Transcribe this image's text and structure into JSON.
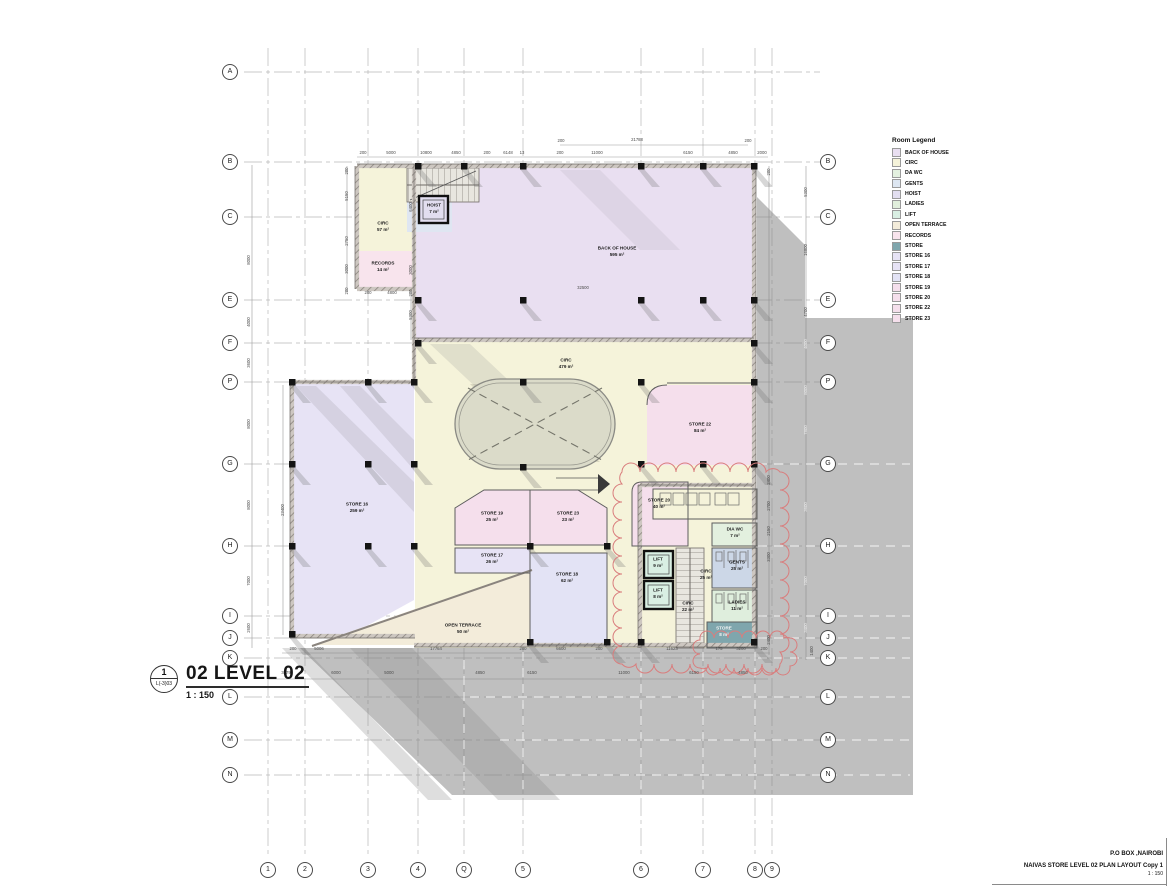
{
  "colors": {
    "shadow": "#808080",
    "grid_line": "#b9b9b9",
    "wall": "#a8a29c",
    "revision_cloud": "#d97d7d",
    "back_of_house": "#e9dff1",
    "circ": "#f5f3da",
    "da_wc": "#e3f0df",
    "gents": "#dde6f1",
    "hoist": "#e2def0",
    "ladies": "#e1efdc",
    "lift": "#d9efe3",
    "open_terrace": "#f3ecda",
    "records": "#f8e4ed",
    "store": "#7fa6ad",
    "store_lavender": "#e7e3f5",
    "store_pink": "#f5dfec"
  },
  "legend": {
    "title": "Room Legend",
    "items": [
      {
        "label": "BACK OF HOUSE",
        "color": "#e9dff1"
      },
      {
        "label": "CIRC",
        "color": "#f5f3da"
      },
      {
        "label": "DA WC",
        "color": "#e3f0df"
      },
      {
        "label": "GENTS",
        "color": "#dde6f1"
      },
      {
        "label": "HOIST",
        "color": "#e2def0"
      },
      {
        "label": "LADIES",
        "color": "#e1efdc"
      },
      {
        "label": "LIFT",
        "color": "#d9efe3"
      },
      {
        "label": "OPEN TERRACE",
        "color": "#f3ecda"
      },
      {
        "label": "RECORDS",
        "color": "#f8e4ed"
      },
      {
        "label": "STORE",
        "color": "#7fa6ad"
      },
      {
        "label": "STORE 16",
        "color": "#e7e3f5"
      },
      {
        "label": "STORE 17",
        "color": "#e7e3f5"
      },
      {
        "label": "STORE 18",
        "color": "#e3e3f5"
      },
      {
        "label": "STORE 19",
        "color": "#f5dfec"
      },
      {
        "label": "STORE 20",
        "color": "#f5dfec"
      },
      {
        "label": "STORE 22",
        "color": "#f5dfec"
      },
      {
        "label": "STORE 23",
        "color": "#f5dfec"
      }
    ]
  },
  "view_title": {
    "marker_number": "1",
    "marker_sheet": "L(-3)03",
    "label": "02 LEVEL 02",
    "scale": "1 : 150"
  },
  "title_block": {
    "address": "P.O BOX ,NAIROBI",
    "drawing": "NAIVAS STORE LEVEL 02 PLAN LAYOUT Copy 1",
    "scale": "1 : 150"
  },
  "grid": {
    "left": [
      {
        "label": "A",
        "x": 230,
        "y": 72
      },
      {
        "label": "B",
        "x": 230,
        "y": 162
      },
      {
        "label": "C",
        "x": 230,
        "y": 217
      },
      {
        "label": "E",
        "x": 230,
        "y": 300
      },
      {
        "label": "F",
        "x": 230,
        "y": 343
      },
      {
        "label": "P",
        "x": 230,
        "y": 382
      },
      {
        "label": "G",
        "x": 230,
        "y": 464
      },
      {
        "label": "H",
        "x": 230,
        "y": 546
      },
      {
        "label": "I",
        "x": 230,
        "y": 616
      },
      {
        "label": "J",
        "x": 230,
        "y": 638
      },
      {
        "label": "K",
        "x": 230,
        "y": 658
      },
      {
        "label": "L",
        "x": 230,
        "y": 697
      },
      {
        "label": "M",
        "x": 230,
        "y": 740
      },
      {
        "label": "N",
        "x": 230,
        "y": 775
      }
    ],
    "right": [
      {
        "label": "B",
        "x": 828,
        "y": 162
      },
      {
        "label": "C",
        "x": 828,
        "y": 217
      },
      {
        "label": "E",
        "x": 828,
        "y": 300
      },
      {
        "label": "F",
        "x": 828,
        "y": 343
      },
      {
        "label": "P",
        "x": 828,
        "y": 382
      },
      {
        "label": "G",
        "x": 828,
        "y": 464
      },
      {
        "label": "H",
        "x": 828,
        "y": 546
      },
      {
        "label": "I",
        "x": 828,
        "y": 616
      },
      {
        "label": "J",
        "x": 828,
        "y": 638
      },
      {
        "label": "K",
        "x": 828,
        "y": 658
      },
      {
        "label": "L",
        "x": 828,
        "y": 697
      },
      {
        "label": "M",
        "x": 828,
        "y": 740
      },
      {
        "label": "N",
        "x": 828,
        "y": 775
      }
    ],
    "bottom": [
      {
        "label": "1",
        "x": 268,
        "y": 870
      },
      {
        "label": "2",
        "x": 305,
        "y": 870
      },
      {
        "label": "3",
        "x": 368,
        "y": 870
      },
      {
        "label": "4",
        "x": 418,
        "y": 870
      },
      {
        "label": "Q",
        "x": 464,
        "y": 870
      },
      {
        "label": "5",
        "x": 523,
        "y": 870
      },
      {
        "label": "6",
        "x": 641,
        "y": 870
      },
      {
        "label": "7",
        "x": 703,
        "y": 870
      },
      {
        "label": "8",
        "x": 755,
        "y": 870
      },
      {
        "label": "9",
        "x": 772,
        "y": 870
      }
    ]
  },
  "rooms": [
    {
      "name": "CIRC",
      "area": "57 m²",
      "x": 383,
      "y": 227
    },
    {
      "name": "RECORDS",
      "area": "14 m²",
      "x": 383,
      "y": 267
    },
    {
      "name": "HOIST",
      "area": "7 m²",
      "x": 434,
      "y": 209
    },
    {
      "name": "BACK OF HOUSE",
      "area": "595 m²",
      "x": 617,
      "y": 252
    },
    {
      "name": "CIRC",
      "area": "479 m²",
      "x": 566,
      "y": 364
    },
    {
      "name": "STORE 16",
      "area": "259 m²",
      "x": 357,
      "y": 508
    },
    {
      "name": "STORE 22",
      "area": "84 m²",
      "x": 700,
      "y": 428
    },
    {
      "name": "STORE 19",
      "area": "25 m²",
      "x": 492,
      "y": 517
    },
    {
      "name": "STORE 23",
      "area": "23 m²",
      "x": 568,
      "y": 517
    },
    {
      "name": "STORE 17",
      "area": "26 m²",
      "x": 492,
      "y": 559
    },
    {
      "name": "STORE 18",
      "area": "62 m²",
      "x": 567,
      "y": 578
    },
    {
      "name": "OPEN TERRACE",
      "area": "50 m²",
      "x": 463,
      "y": 629
    },
    {
      "name": "STORE 20",
      "area": "40 m²",
      "x": 659,
      "y": 504
    },
    {
      "name": "DIA WC",
      "area": "7 m²",
      "x": 735,
      "y": 533
    },
    {
      "name": "GENTS",
      "area": "25 m²",
      "x": 737,
      "y": 566
    },
    {
      "name": "CIRC",
      "area": "25 m²",
      "x": 706,
      "y": 575
    },
    {
      "name": "LADIES",
      "area": "11 m²",
      "x": 737,
      "y": 606
    },
    {
      "name": "CIRC",
      "area": "22 m²",
      "x": 688,
      "y": 607
    },
    {
      "name": "STORE",
      "area": "8 m²",
      "x": 724,
      "y": 632,
      "cls": "on-dark"
    },
    {
      "name": "LIFT",
      "area": "9 m²",
      "x": 658,
      "y": 563
    },
    {
      "name": "LIFT",
      "area": "8 m²",
      "x": 658,
      "y": 594
    }
  ],
  "dims": [
    {
      "t": "21788",
      "x": 637,
      "y": 140
    },
    {
      "t": "200",
      "x": 561,
      "y": 141
    },
    {
      "t": "200",
      "x": 748,
      "y": 141
    },
    {
      "t": "200",
      "x": 363,
      "y": 153
    },
    {
      "t": "5000",
      "x": 391,
      "y": 153
    },
    {
      "t": "10800",
      "x": 426,
      "y": 153
    },
    {
      "t": "4850",
      "x": 456,
      "y": 153
    },
    {
      "t": "200",
      "x": 487,
      "y": 153
    },
    {
      "t": "6148",
      "x": 508,
      "y": 153
    },
    {
      "t": "13",
      "x": 522,
      "y": 153
    },
    {
      "t": "200",
      "x": 560,
      "y": 153
    },
    {
      "t": "11000",
      "x": 597,
      "y": 153
    },
    {
      "t": "6150",
      "x": 688,
      "y": 153
    },
    {
      "t": "4850",
      "x": 733,
      "y": 153
    },
    {
      "t": "2000",
      "x": 762,
      "y": 153
    },
    {
      "t": "5150",
      "x": 347,
      "y": 196,
      "cls": "v"
    },
    {
      "t": "2750",
      "x": 347,
      "y": 241,
      "cls": "v"
    },
    {
      "t": "3000",
      "x": 347,
      "y": 269,
      "cls": "v"
    },
    {
      "t": "200",
      "x": 347,
      "y": 171,
      "cls": "v"
    },
    {
      "t": "200",
      "x": 347,
      "y": 291,
      "cls": "v"
    },
    {
      "t": "6400",
      "x": 411,
      "y": 207,
      "cls": "v"
    },
    {
      "t": "3000",
      "x": 411,
      "y": 270,
      "cls": "v"
    },
    {
      "t": "200",
      "x": 411,
      "y": 293,
      "cls": "v"
    },
    {
      "t": "5300",
      "x": 411,
      "y": 315,
      "cls": "v"
    },
    {
      "t": "32500",
      "x": 583,
      "y": 288
    },
    {
      "t": "200",
      "x": 368,
      "y": 293
    },
    {
      "t": "4800",
      "x": 392,
      "y": 293
    },
    {
      "t": "200",
      "x": 293,
      "y": 649
    },
    {
      "t": "5006",
      "x": 319,
      "y": 649
    },
    {
      "t": "17764",
      "x": 436,
      "y": 649
    },
    {
      "t": "200",
      "x": 523,
      "y": 649
    },
    {
      "t": "6600",
      "x": 561,
      "y": 649
    },
    {
      "t": "200",
      "x": 599,
      "y": 649
    },
    {
      "t": "11623",
      "x": 672,
      "y": 649
    },
    {
      "t": "175",
      "x": 719,
      "y": 649
    },
    {
      "t": "3200",
      "x": 741,
      "y": 649
    },
    {
      "t": "200",
      "x": 764,
      "y": 649
    },
    {
      "t": "3579",
      "x": 286,
      "y": 673
    },
    {
      "t": "6000",
      "x": 336,
      "y": 673
    },
    {
      "t": "5000",
      "x": 389,
      "y": 673
    },
    {
      "t": "4850",
      "x": 480,
      "y": 673
    },
    {
      "t": "6150",
      "x": 532,
      "y": 673
    },
    {
      "t": "11000",
      "x": 624,
      "y": 673
    },
    {
      "t": "6150",
      "x": 694,
      "y": 673
    },
    {
      "t": "4850",
      "x": 743,
      "y": 673
    },
    {
      "t": "8000",
      "x": 249,
      "y": 260,
      "cls": "v"
    },
    {
      "t": "4000",
      "x": 249,
      "y": 322,
      "cls": "v"
    },
    {
      "t": "3600",
      "x": 249,
      "y": 363,
      "cls": "v"
    },
    {
      "t": "8000",
      "x": 249,
      "y": 424,
      "cls": "v"
    },
    {
      "t": "8000",
      "x": 249,
      "y": 505,
      "cls": "v"
    },
    {
      "t": "7000",
      "x": 249,
      "y": 581,
      "cls": "v"
    },
    {
      "t": "2600",
      "x": 249,
      "y": 628,
      "cls": "v"
    },
    {
      "t": "23400",
      "x": 283,
      "y": 510,
      "cls": "v"
    },
    {
      "t": "1400",
      "x": 812,
      "y": 651,
      "cls": "v"
    },
    {
      "t": "200",
      "x": 769,
      "y": 172,
      "cls": "v"
    },
    {
      "t": "2400",
      "x": 769,
      "y": 480,
      "cls": "v"
    },
    {
      "t": "2700",
      "x": 769,
      "y": 506,
      "cls": "v"
    },
    {
      "t": "2150",
      "x": 769,
      "y": 531,
      "cls": "v"
    },
    {
      "t": "3300",
      "x": 769,
      "y": 557,
      "cls": "v"
    },
    {
      "t": "2400",
      "x": 769,
      "y": 640,
      "cls": "v"
    },
    {
      "t": "5300",
      "x": 806,
      "y": 192,
      "cls": "v"
    },
    {
      "t": "16800",
      "x": 806,
      "y": 250,
      "cls": "v"
    },
    {
      "t": "4700",
      "x": 806,
      "y": 312,
      "cls": "v"
    },
    {
      "t": "4000",
      "x": 806,
      "y": 344,
      "cls": "vlight"
    },
    {
      "t": "8000",
      "x": 806,
      "y": 390,
      "cls": "vlight"
    },
    {
      "t": "7800",
      "x": 806,
      "y": 430,
      "cls": "vlight"
    },
    {
      "t": "3600",
      "x": 806,
      "y": 507,
      "cls": "vlight"
    },
    {
      "t": "7000",
      "x": 806,
      "y": 581,
      "cls": "vlight"
    },
    {
      "t": "3400",
      "x": 806,
      "y": 628,
      "cls": "vlight"
    }
  ]
}
